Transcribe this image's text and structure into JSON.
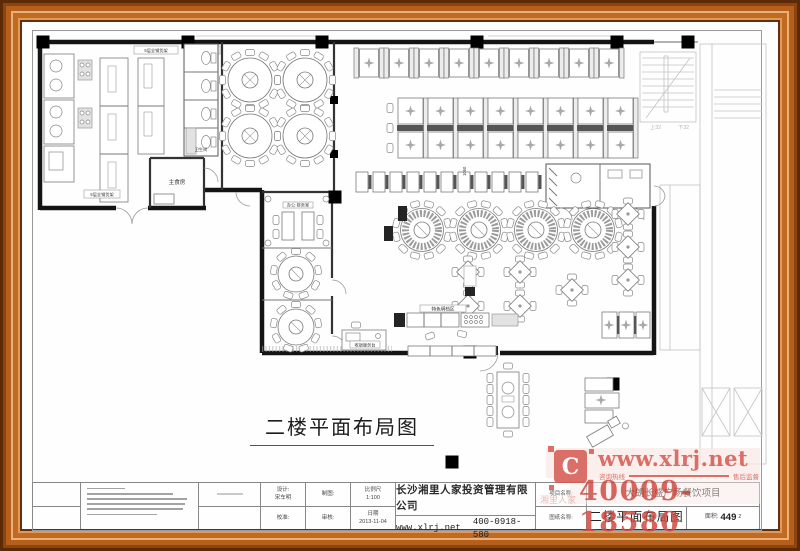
{
  "plan": {
    "title": "二楼平面布局图",
    "labels": {
      "shelf": "5层全钢货架",
      "main_food": "主食房",
      "wc": "卫生间",
      "office": "办公·财务室",
      "cashier": "收银服务台",
      "display": "特色明档区",
      "stair_up": "上32",
      "stair_down": "下32",
      "dim": "1060"
    }
  },
  "title_block": {
    "design_label": "设计:",
    "design_name": "宋车明",
    "check_label": "校准:",
    "draft_label": "制图:",
    "review_label": "审核:",
    "scale_label": "比例尺",
    "scale_value": "1:100",
    "date_label": "日期",
    "date_value": "2013-11-04",
    "company": "长沙湘里人家投资管理有限公司",
    "website": "www.xlrj.net",
    "phone": "400-0918-580",
    "project_label": "项目名称:",
    "project_name": "大朗长盛广场餐饮项目",
    "drawing_label": "图纸名称:",
    "drawing_name": "二楼平面布局图",
    "area_label": "面积:",
    "area_value": "449",
    "area_sup": "2"
  },
  "stamp": {
    "logo": "C",
    "site": "www.xlrj.net",
    "tagline_left": "咨询热线",
    "tagline_right": "售后监督",
    "hotline": "40009-18580",
    "brand": "湘里人家",
    "color": "#d4574e"
  }
}
